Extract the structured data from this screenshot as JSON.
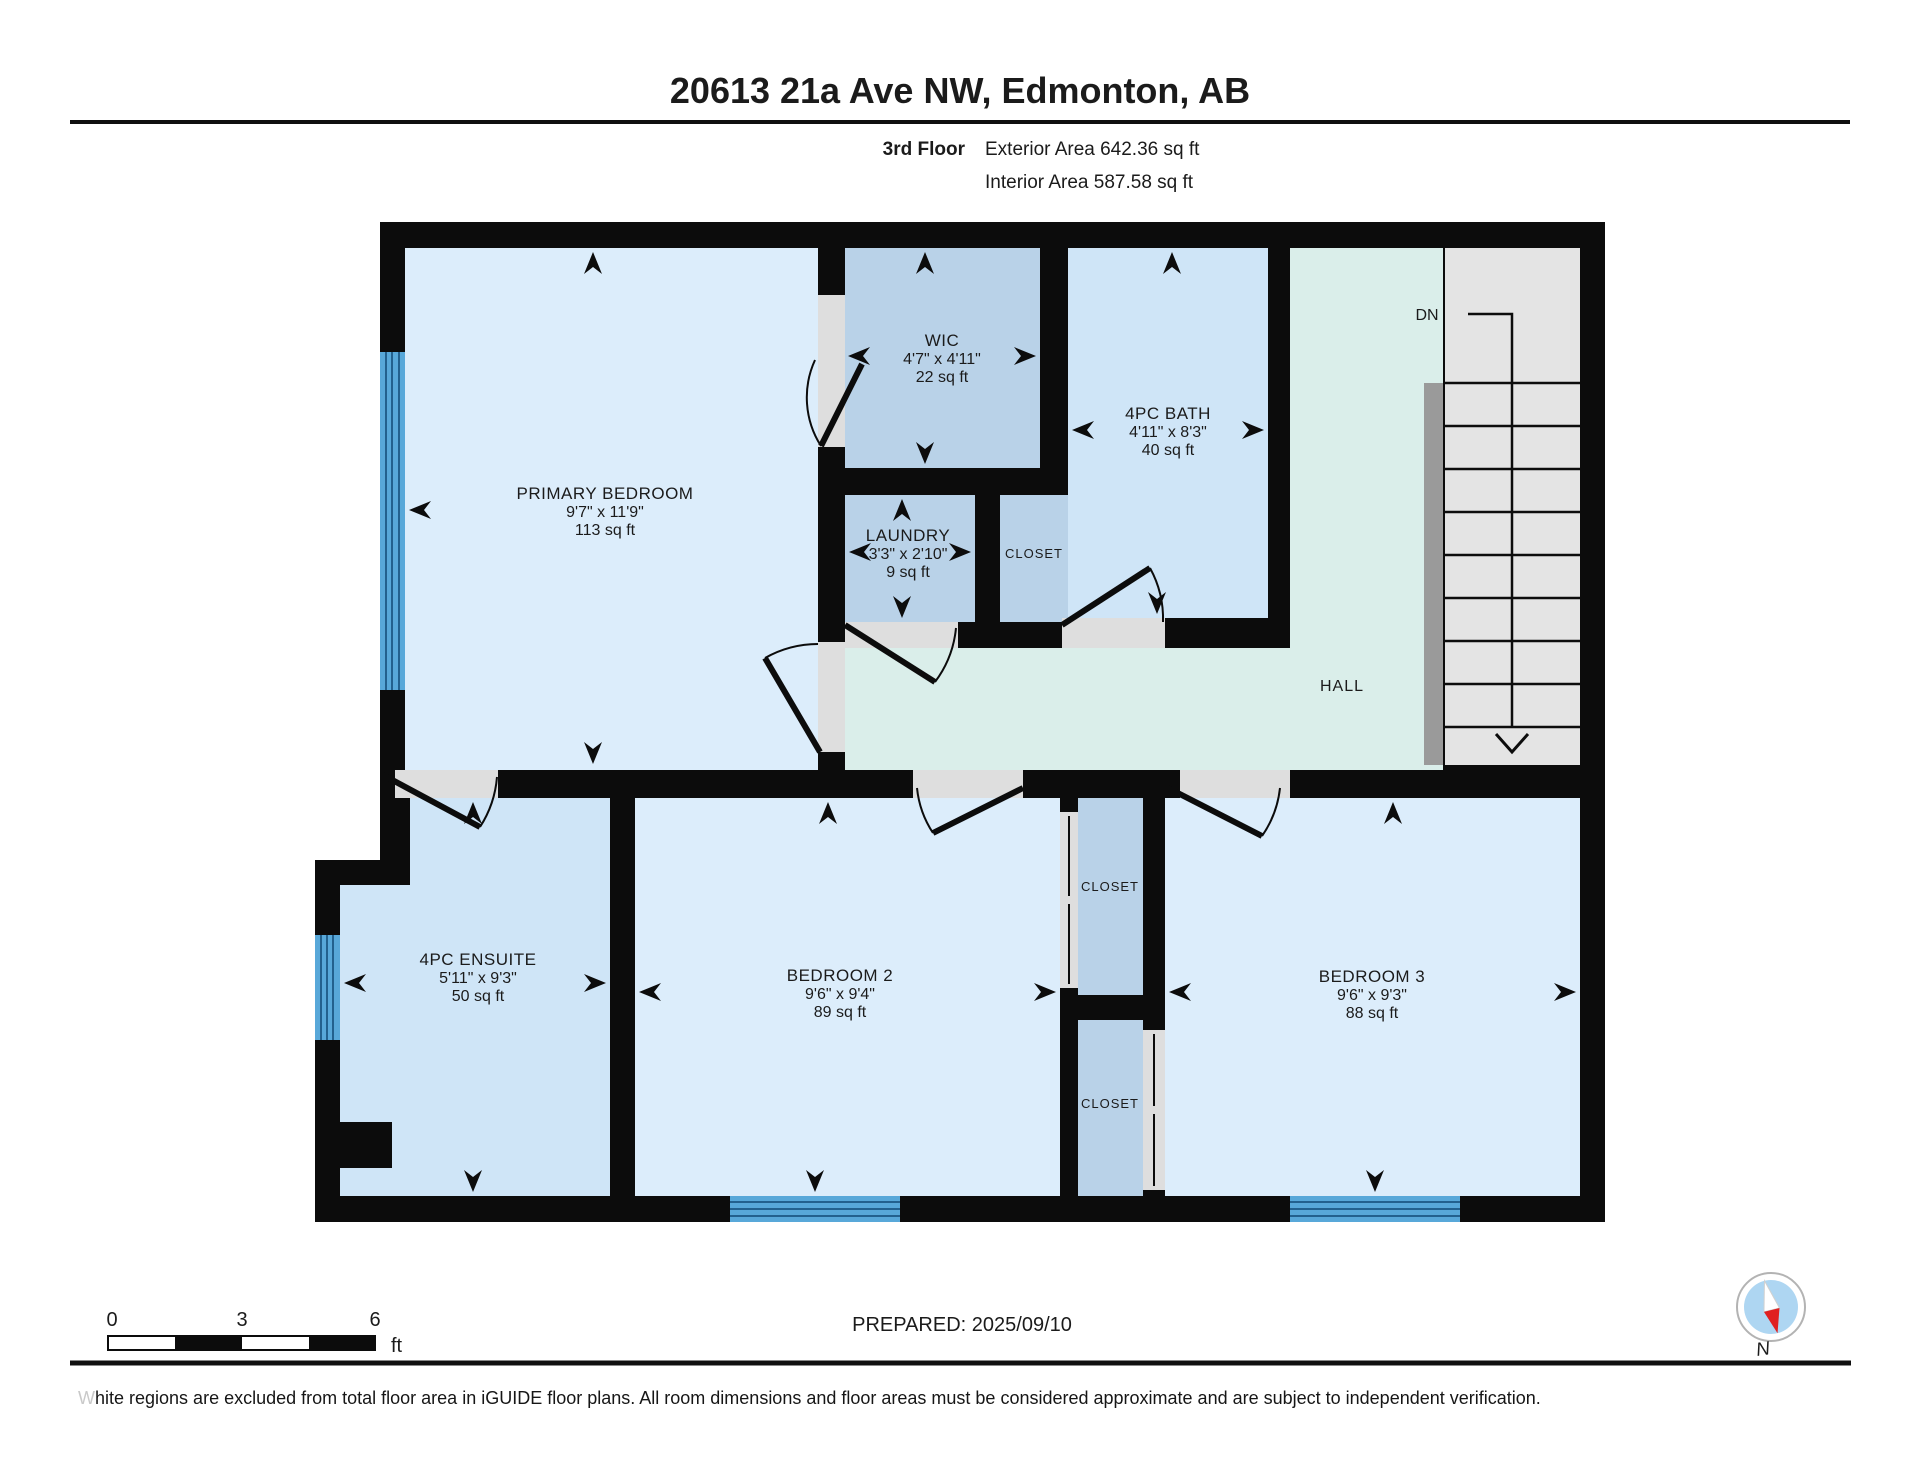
{
  "header": {
    "title": "20613 21a Ave NW, Edmonton, AB",
    "floor_label": "3rd Floor",
    "exterior_area": "Exterior Area 642.36 sq ft",
    "interior_area": "Interior Area 587.58 sq ft"
  },
  "rooms": {
    "primary": {
      "name": "PRIMARY BEDROOM",
      "dims": "9'7\" x 11'9\"",
      "area": "113 sq ft"
    },
    "wic": {
      "name": "WIC",
      "dims": "4'7\" x 4'11\"",
      "area": "22 sq ft"
    },
    "bath": {
      "name": "4PC BATH",
      "dims": "4'11\" x 8'3\"",
      "area": "40 sq ft"
    },
    "laundry": {
      "name": "LAUNDRY",
      "dims": "3'3\" x 2'10\"",
      "area": "9 sq ft"
    },
    "ensuite": {
      "name": "4PC ENSUITE",
      "dims": "5'11\" x 9'3\"",
      "area": "50 sq ft"
    },
    "bedroom2": {
      "name": "BEDROOM 2",
      "dims": "9'6\" x 9'4\"",
      "area": "89 sq ft"
    },
    "bedroom3": {
      "name": "BEDROOM 3",
      "dims": "9'6\" x 9'3\"",
      "area": "88 sq ft"
    },
    "closet_hall": {
      "label": "CLOSET"
    },
    "closet_top": {
      "label": "CLOSET"
    },
    "closet_bottom": {
      "label": "CLOSET"
    },
    "hall": {
      "label": "HALL"
    },
    "stairs": {
      "down_label": "DN"
    }
  },
  "scale_bar": {
    "zero": "0",
    "three": "3",
    "six": "6",
    "unit": "ft"
  },
  "footer": {
    "prepared": "PREPARED: 2025/09/10",
    "disclaimer_lead": "W",
    "disclaimer_rest": "hite regions are excluded from total floor area in iGUIDE floor plans. All room dimensions and floor areas must be considered approximate and are subject to independent verification.",
    "compass_n": "N"
  },
  "colors": {
    "wall": "#0c0c0c",
    "room_light": "#dcedfb",
    "room_medium": "#b9d2e8",
    "bath_blue": "#cfe5f7",
    "hall_mint": "#daeeea",
    "stairs_gray": "#e4e4e4",
    "handrail_gray": "#9a9a9a",
    "opening_gray": "#dedede",
    "window_blue": "#58a8d9",
    "window_line": "#23618e",
    "compass_red": "#e02020",
    "compass_blue": "#aed6f2"
  }
}
